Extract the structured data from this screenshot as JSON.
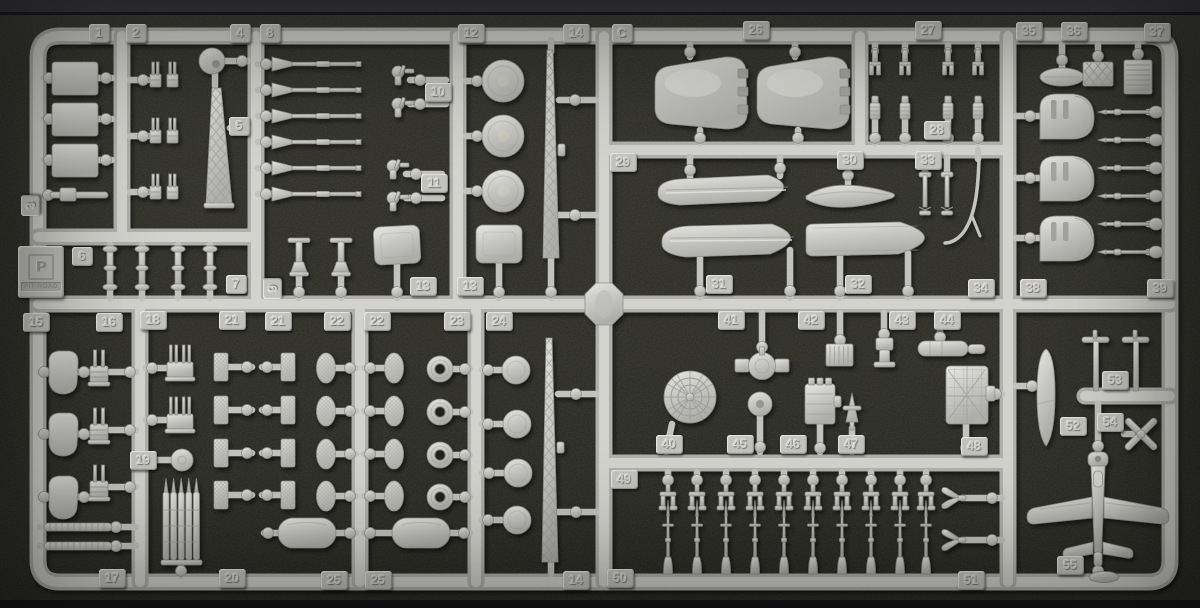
{
  "sprue": {
    "letter": "C",
    "description_visible_text_only": "",
    "colors": {
      "plastic": "#c9c9c5",
      "plastic_shadow": "#8e8e8a",
      "foam_background": "#292922",
      "tag_plate": "#c2c2be"
    }
  },
  "brand": {
    "name": "PIT-ROAD",
    "monogram": "P"
  },
  "part_tags": [
    {
      "label": "1",
      "x": 99,
      "y": 33
    },
    {
      "label": "2",
      "x": 136,
      "y": 33
    },
    {
      "label": "3",
      "x": 30,
      "y": 205,
      "rot": true
    },
    {
      "label": "4",
      "x": 240,
      "y": 33
    },
    {
      "label": "8",
      "x": 270,
      "y": 33
    },
    {
      "label": "5",
      "x": 239,
      "y": 126
    },
    {
      "label": "6",
      "x": 82,
      "y": 256
    },
    {
      "label": "7",
      "x": 236,
      "y": 284
    },
    {
      "label": "9",
      "x": 272,
      "y": 288,
      "rot": true
    },
    {
      "label": "10",
      "x": 438,
      "y": 92
    },
    {
      "label": "11",
      "x": 434,
      "y": 183
    },
    {
      "label": "12",
      "x": 471,
      "y": 33
    },
    {
      "label": "13",
      "x": 423,
      "y": 286
    },
    {
      "label": "13",
      "x": 470,
      "y": 286
    },
    {
      "label": "14",
      "x": 576,
      "y": 33
    },
    {
      "label": "C",
      "x": 622,
      "y": 33
    },
    {
      "label": "26",
      "x": 756,
      "y": 30
    },
    {
      "label": "27",
      "x": 928,
      "y": 30
    },
    {
      "label": "28",
      "x": 937,
      "y": 130
    },
    {
      "label": "29",
      "x": 623,
      "y": 162
    },
    {
      "label": "30",
      "x": 850,
      "y": 160
    },
    {
      "label": "33",
      "x": 928,
      "y": 160
    },
    {
      "label": "31",
      "x": 719,
      "y": 284
    },
    {
      "label": "32",
      "x": 858,
      "y": 284
    },
    {
      "label": "34",
      "x": 981,
      "y": 288
    },
    {
      "label": "35",
      "x": 1029,
      "y": 31
    },
    {
      "label": "36",
      "x": 1074,
      "y": 31
    },
    {
      "label": "37",
      "x": 1157,
      "y": 32
    },
    {
      "label": "38",
      "x": 1033,
      "y": 288
    },
    {
      "label": "39",
      "x": 1160,
      "y": 288
    },
    {
      "label": "15",
      "x": 36,
      "y": 322
    },
    {
      "label": "16",
      "x": 109,
      "y": 322
    },
    {
      "label": "18",
      "x": 153,
      "y": 320
    },
    {
      "label": "21",
      "x": 232,
      "y": 320
    },
    {
      "label": "19",
      "x": 143,
      "y": 460
    },
    {
      "label": "17",
      "x": 112,
      "y": 578
    },
    {
      "label": "20",
      "x": 232,
      "y": 578
    },
    {
      "label": "21",
      "x": 278,
      "y": 321
    },
    {
      "label": "22",
      "x": 337,
      "y": 321
    },
    {
      "label": "22",
      "x": 377,
      "y": 321
    },
    {
      "label": "23",
      "x": 457,
      "y": 321
    },
    {
      "label": "24",
      "x": 499,
      "y": 321
    },
    {
      "label": "25",
      "x": 334,
      "y": 580
    },
    {
      "label": "25",
      "x": 378,
      "y": 580
    },
    {
      "label": "14",
      "x": 576,
      "y": 580
    },
    {
      "label": "41",
      "x": 731,
      "y": 320
    },
    {
      "label": "42",
      "x": 811,
      "y": 320
    },
    {
      "label": "43",
      "x": 902,
      "y": 320
    },
    {
      "label": "44",
      "x": 947,
      "y": 320
    },
    {
      "label": "40",
      "x": 669,
      "y": 444
    },
    {
      "label": "45",
      "x": 740,
      "y": 444
    },
    {
      "label": "46",
      "x": 793,
      "y": 444
    },
    {
      "label": "47",
      "x": 851,
      "y": 444
    },
    {
      "label": "48",
      "x": 974,
      "y": 446
    },
    {
      "label": "49",
      "x": 624,
      "y": 479
    },
    {
      "label": "50",
      "x": 620,
      "y": 578
    },
    {
      "label": "51",
      "x": 971,
      "y": 580
    },
    {
      "label": "53",
      "x": 1115,
      "y": 380
    },
    {
      "label": "52",
      "x": 1073,
      "y": 426
    },
    {
      "label": "54",
      "x": 1110,
      "y": 422
    },
    {
      "label": "55",
      "x": 1070,
      "y": 565
    }
  ]
}
